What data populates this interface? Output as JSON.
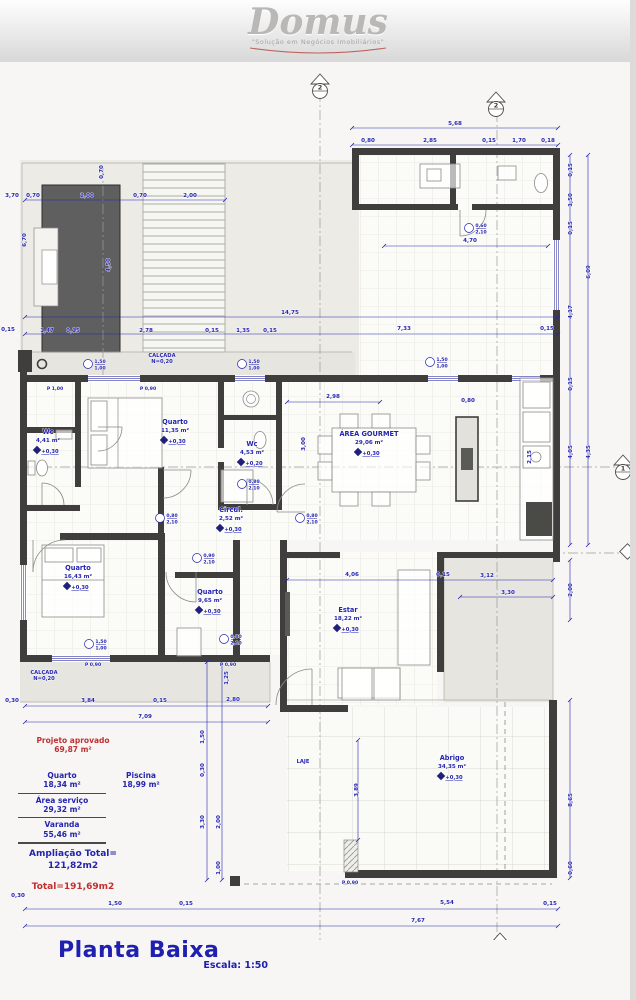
{
  "logo": {
    "name": "Domus",
    "tagline": "\"Solução em Negócios Imobiliários\""
  },
  "title_block": {
    "title": "Planta Baixa",
    "scale": "Escala: 1:50"
  },
  "legend": {
    "approved_label": "Projeto aprovado",
    "approved_area": "69,87 m²",
    "items": [
      {
        "name": "Quarto",
        "area": "18,34 m²"
      },
      {
        "name": "Área serviço",
        "area": "29,32 m²"
      },
      {
        "name": "Varanda",
        "area": "55,46 m²"
      }
    ],
    "piscina": {
      "name": "Piscina",
      "area": "18,99 m²"
    },
    "ampliacao_label": "Ampliação Total=",
    "ampliacao_value": "121,82m2",
    "total": "Total=191,69m2"
  },
  "plan": {
    "colors": {
      "dimension_blue": "#2424b0",
      "accent_red": "#c03030",
      "wall": "#3f3e3c",
      "pool": "#5f5f5f"
    },
    "rooms": [
      {
        "name": "Quarto",
        "area": "11,35 m²",
        "level": "+0,30",
        "x": 175,
        "y": 424
      },
      {
        "name": "Wc",
        "area": "4,41 m²",
        "level": "+0,30",
        "x": 48,
        "y": 434
      },
      {
        "name": "Wc",
        "area": "4,53 m²",
        "level": "+0,20",
        "x": 252,
        "y": 446
      },
      {
        "name": "ÁREA GOURMET",
        "area": "29,06 m²",
        "level": "+0,30",
        "x": 369,
        "y": 436
      },
      {
        "name": "Circul.",
        "area": "2,52 m²",
        "level": "+0,30",
        "x": 231,
        "y": 512
      },
      {
        "name": "Quarto",
        "area": "16,43 m²",
        "level": "+0,30",
        "x": 78,
        "y": 570
      },
      {
        "name": "Quarto",
        "area": "9,65 m²",
        "level": "+0,30",
        "x": 210,
        "y": 594
      },
      {
        "name": "Estar",
        "area": "18,22 m²",
        "level": "+0,30",
        "x": 348,
        "y": 612
      },
      {
        "name": "Abrigo",
        "area": "34,35 m²",
        "level": "+0,30",
        "x": 452,
        "y": 760
      }
    ],
    "dimensions": [
      {
        "t": "5,68",
        "x": 455,
        "y": 125
      },
      {
        "t": "0,80",
        "x": 368,
        "y": 142
      },
      {
        "t": "2,85",
        "x": 430,
        "y": 142
      },
      {
        "t": "0,15",
        "x": 489,
        "y": 142
      },
      {
        "t": "1,70",
        "x": 519,
        "y": 142
      },
      {
        "t": "0,18",
        "x": 548,
        "y": 142
      },
      {
        "t": "3,70",
        "x": 12,
        "y": 197
      },
      {
        "t": "0,70",
        "x": 33,
        "y": 197
      },
      {
        "t": "2,00",
        "x": 87,
        "y": 197
      },
      {
        "t": "0,70",
        "x": 140,
        "y": 197
      },
      {
        "t": "2,00",
        "x": 190,
        "y": 197
      },
      {
        "t": "6,70",
        "x": 26,
        "y": 240,
        "v": 1
      },
      {
        "t": "0,70",
        "x": 103,
        "y": 172,
        "v": 1
      },
      {
        "t": "4,50",
        "x": 110,
        "y": 265,
        "v": 1
      },
      {
        "t": "14,75",
        "x": 290,
        "y": 314
      },
      {
        "t": "0,15",
        "x": 8,
        "y": 331
      },
      {
        "t": "1,47",
        "x": 47,
        "y": 332
      },
      {
        "t": "0,15",
        "x": 73,
        "y": 332
      },
      {
        "t": "2,78",
        "x": 146,
        "y": 332
      },
      {
        "t": "0,15",
        "x": 212,
        "y": 332
      },
      {
        "t": "1,35",
        "x": 243,
        "y": 332
      },
      {
        "t": "0,15",
        "x": 270,
        "y": 332
      },
      {
        "t": "7,33",
        "x": 404,
        "y": 330
      },
      {
        "t": "0,15",
        "x": 547,
        "y": 330
      },
      {
        "t": "0,15",
        "x": 572,
        "y": 170,
        "v": 1
      },
      {
        "t": "1,50",
        "x": 572,
        "y": 200,
        "v": 1
      },
      {
        "t": "0,15",
        "x": 572,
        "y": 228,
        "v": 1
      },
      {
        "t": "4,17",
        "x": 572,
        "y": 312,
        "v": 1
      },
      {
        "t": "6,09",
        "x": 590,
        "y": 272,
        "v": 1
      },
      {
        "t": "0,15",
        "x": 572,
        "y": 384,
        "v": 1
      },
      {
        "t": "4,05",
        "x": 572,
        "y": 452,
        "v": 1
      },
      {
        "t": "4,35",
        "x": 590,
        "y": 452,
        "v": 1
      },
      {
        "t": "2,00",
        "x": 572,
        "y": 590,
        "v": 1
      },
      {
        "t": "8,65",
        "x": 572,
        "y": 800,
        "v": 1
      },
      {
        "t": "0,60",
        "x": 572,
        "y": 868,
        "v": 1
      },
      {
        "t": "4,70",
        "x": 470,
        "y": 242
      },
      {
        "t": "2,98",
        "x": 333,
        "y": 398
      },
      {
        "t": "3,00",
        "x": 305,
        "y": 444,
        "v": 1
      },
      {
        "t": "2,15",
        "x": 531,
        "y": 457,
        "v": 1
      },
      {
        "t": "0,80",
        "x": 468,
        "y": 402
      },
      {
        "t": "4,06",
        "x": 352,
        "y": 576
      },
      {
        "t": "0,15",
        "x": 443,
        "y": 576
      },
      {
        "t": "3,12",
        "x": 487,
        "y": 577
      },
      {
        "t": "3,30",
        "x": 508,
        "y": 594
      },
      {
        "t": "0,30",
        "x": 12,
        "y": 702
      },
      {
        "t": "3,84",
        "x": 88,
        "y": 702
      },
      {
        "t": "0,15",
        "x": 160,
        "y": 702
      },
      {
        "t": "2,80",
        "x": 233,
        "y": 701
      },
      {
        "t": "7,09",
        "x": 145,
        "y": 718
      },
      {
        "t": "1,25",
        "x": 228,
        "y": 678,
        "v": 1
      },
      {
        "t": "1,50",
        "x": 204,
        "y": 737,
        "v": 1
      },
      {
        "t": "0,30",
        "x": 204,
        "y": 770,
        "v": 1
      },
      {
        "t": "3,30",
        "x": 204,
        "y": 822,
        "v": 1
      },
      {
        "t": "2,00",
        "x": 220,
        "y": 822,
        "v": 1
      },
      {
        "t": "1,00",
        "x": 220,
        "y": 868,
        "v": 1
      },
      {
        "t": "3,89",
        "x": 358,
        "y": 790,
        "v": 1
      },
      {
        "t": "0,30",
        "x": 18,
        "y": 897
      },
      {
        "t": "1,50",
        "x": 115,
        "y": 905
      },
      {
        "t": "0,15",
        "x": 186,
        "y": 905
      },
      {
        "t": "5,54",
        "x": 447,
        "y": 904
      },
      {
        "t": "0,15",
        "x": 550,
        "y": 905
      },
      {
        "t": "7,67",
        "x": 418,
        "y": 922
      }
    ],
    "door_tags": [
      {
        "t": "P 1,00",
        "x": 55,
        "y": 390
      },
      {
        "t": "P 0,90",
        "x": 148,
        "y": 390
      },
      {
        "t": "P 0,90",
        "x": 93,
        "y": 666
      },
      {
        "t": "P 0,90",
        "x": 228,
        "y": 666
      },
      {
        "t": "P 0,90",
        "x": 350,
        "y": 884
      }
    ],
    "size_tags": [
      {
        "a": "1,50",
        "b": "1,00",
        "x": 96,
        "y": 366
      },
      {
        "a": "1,50",
        "b": "1,00",
        "x": 250,
        "y": 366
      },
      {
        "a": "1,50",
        "b": "1,00",
        "x": 438,
        "y": 364
      },
      {
        "a": "0,80",
        "b": "2,10",
        "x": 168,
        "y": 520
      },
      {
        "a": "0,80",
        "b": "2,10",
        "x": 308,
        "y": 520
      },
      {
        "a": "0,90",
        "b": "2,10",
        "x": 205,
        "y": 560
      },
      {
        "a": "0,80",
        "b": "2,10",
        "x": 232,
        "y": 641
      },
      {
        "a": "0,60",
        "b": "2,10",
        "x": 477,
        "y": 230
      },
      {
        "a": "1,50",
        "b": "1,00",
        "x": 97,
        "y": 646
      },
      {
        "a": "0,80",
        "b": "2,10",
        "x": 250,
        "y": 486
      }
    ],
    "annotations": [
      {
        "t": "CALÇADA",
        "x": 162,
        "y": 357
      },
      {
        "t": "N=0,20",
        "x": 162,
        "y": 363
      },
      {
        "t": "CALÇADA",
        "x": 44,
        "y": 674
      },
      {
        "t": "N=0,20",
        "x": 44,
        "y": 680
      },
      {
        "t": "LAJE",
        "x": 303,
        "y": 763
      }
    ],
    "markers": [
      {
        "t": "2",
        "x": 320,
        "y": 86
      },
      {
        "t": "2",
        "x": 496,
        "y": 104
      },
      {
        "t": "1",
        "x": 623,
        "y": 467
      },
      {
        "t": "1",
        "x": 500,
        "y": 945
      },
      {
        "t": "1",
        "x": 296,
        "y": 959
      }
    ]
  }
}
